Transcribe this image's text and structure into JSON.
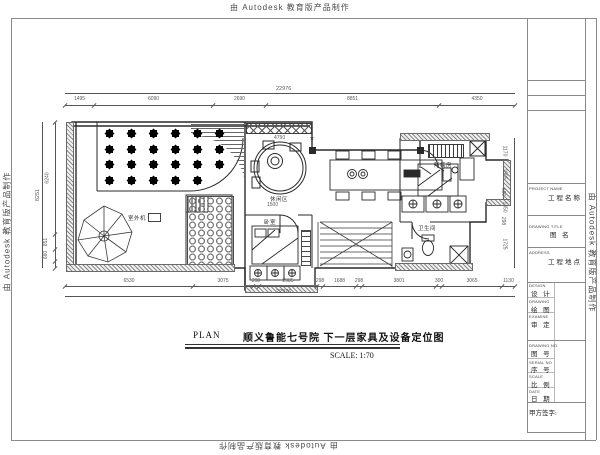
{
  "watermark": {
    "text": "由 Autodesk 教育版产品制作"
  },
  "title_row": {
    "plan_label": "PLAN",
    "drawing_name": "顺义鲁能七号院 下一层家具及设备定位图",
    "scale_label": "SCALE: 1:70"
  },
  "title_block": {
    "project": {
      "en": "PROJECT NAME",
      "cn": "工程名称"
    },
    "drawing_title": {
      "en": "DRAWING TITLE",
      "cn": "图  名"
    },
    "address": {
      "en": "ADDRESS",
      "cn": "工程地点"
    },
    "design": {
      "en": "DESIGN",
      "cn": "设 计"
    },
    "draw": {
      "en": "DRAWING",
      "cn": "绘 图"
    },
    "examine": {
      "en": "EXAMINE",
      "cn": "审 定"
    },
    "drawing_no": {
      "en": "DRAWING NO",
      "cn": "图 号"
    },
    "serial_no": {
      "en": "SERIAL NO",
      "cn": "序 号"
    },
    "scale": {
      "en": "SCALE",
      "cn": "比 例"
    },
    "date": {
      "en": "DATE",
      "cn": "日 期"
    },
    "signature": "甲方签字:"
  },
  "plan": {
    "room_labels": {
      "lounge": "休闲区",
      "bedroom": "卧室",
      "maid_room": "阿姨房",
      "bathroom": "卫生间",
      "outdoor_unit": "室外机"
    },
    "dims": {
      "top": {
        "total": "22976",
        "segments": [
          "1495",
          "6090",
          "2690",
          "8851",
          "4350"
        ]
      },
      "bottom": {
        "total": "22976",
        "segments": [
          "6530",
          "3075",
          "298",
          "2985",
          "298",
          "1688",
          "298",
          "3801",
          "300",
          "3065",
          "1130"
        ]
      },
      "left": {
        "total": "8251",
        "segments": [
          "6240",
          "851",
          "660"
        ]
      },
      "right": {
        "segments": [
          "1170",
          "1905",
          "600",
          "1450",
          "298",
          "1725"
        ]
      },
      "inner": {
        "lounge_width": "4750",
        "bed_width": "1500"
      }
    }
  }
}
